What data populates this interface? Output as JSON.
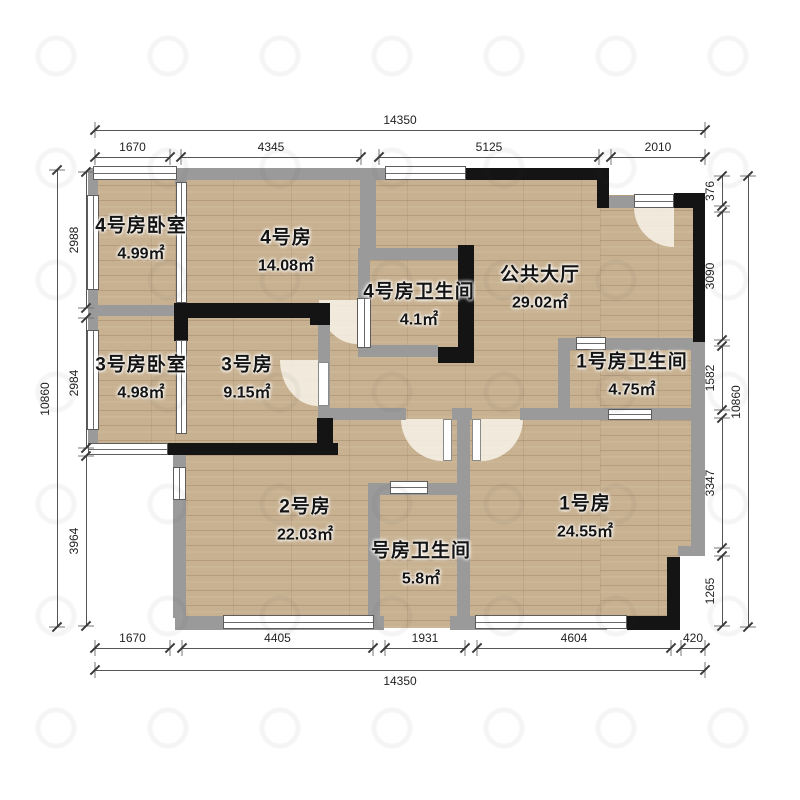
{
  "plan_title": "户型图",
  "colors": {
    "floor": "#c8b190",
    "wall_gray": "#9a9a9a",
    "wall_black": "#141414",
    "dim_text": "#222222",
    "door_arc": "#faf6ed",
    "background": "#ffffff"
  },
  "rooms": [
    {
      "id": "bedroom-4",
      "name": "4号房卧室",
      "area": "4.99㎡",
      "cx": 141,
      "cy": 237
    },
    {
      "id": "room-4",
      "name": "4号房",
      "area": "14.08㎡",
      "cx": 286,
      "cy": 249
    },
    {
      "id": "bath-4",
      "name": "4号房卫生间",
      "area": "4.1㎡",
      "cx": 419,
      "cy": 303
    },
    {
      "id": "public-hall",
      "name": "公共大厅",
      "area": "29.02㎡",
      "cx": 540,
      "cy": 286
    },
    {
      "id": "bedroom-3",
      "name": "3号房卧室",
      "area": "4.98㎡",
      "cx": 141,
      "cy": 376
    },
    {
      "id": "room-3",
      "name": "3号房",
      "area": "9.15㎡",
      "cx": 247,
      "cy": 376
    },
    {
      "id": "bath-1",
      "name": "1号房卫生间",
      "area": "4.75㎡",
      "cx": 632,
      "cy": 373
    },
    {
      "id": "room-2",
      "name": "2号房",
      "area": "22.03㎡",
      "cx": 305,
      "cy": 518
    },
    {
      "id": "bath-hall",
      "name": "号房卫生间",
      "area": "5.8㎡",
      "cx": 421,
      "cy": 562
    },
    {
      "id": "room-1",
      "name": "1号房",
      "area": "24.55㎡",
      "cx": 585,
      "cy": 515
    }
  ],
  "dimensions": {
    "top": {
      "total": {
        "label": "14350",
        "from": 95,
        "to": 705,
        "line": 130
      },
      "segments_line": 157,
      "segments": [
        {
          "label": "1670",
          "from": 95,
          "to": 170
        },
        {
          "label": "4345",
          "from": 181,
          "to": 361
        },
        {
          "label": "5125",
          "from": 379,
          "to": 599
        },
        {
          "label": "2010",
          "from": 611,
          "to": 705
        }
      ]
    },
    "bottom": {
      "total": {
        "label": "14350",
        "from": 95,
        "to": 705,
        "line": 670
      },
      "segments_line": 648,
      "segments": [
        {
          "label": "1670",
          "from": 95,
          "to": 170
        },
        {
          "label": "4405",
          "from": 182,
          "to": 373
        },
        {
          "label": "1931",
          "from": 385,
          "to": 465
        },
        {
          "label": "4604",
          "from": 477,
          "to": 671
        },
        {
          "label": "420",
          "from": 681,
          "to": 705
        }
      ]
    },
    "left": {
      "total": {
        "label": "10860",
        "from": 170,
        "to": 627,
        "line": 57
      },
      "segments_line": 86,
      "segments": [
        {
          "label": "2988",
          "from": 172,
          "to": 308
        },
        {
          "label": "2984",
          "from": 318,
          "to": 448
        },
        {
          "label": "3964",
          "from": 456,
          "to": 626
        }
      ]
    },
    "right": {
      "total": {
        "label": "10860",
        "from": 176,
        "to": 627,
        "line": 748
      },
      "segments_line": 722,
      "segments": [
        {
          "label": "376",
          "from": 176,
          "to": 206
        },
        {
          "label": "3090",
          "from": 212,
          "to": 340
        },
        {
          "label": "1582",
          "from": 346,
          "to": 410
        },
        {
          "label": "3347",
          "from": 418,
          "to": 548
        },
        {
          "label": "1265",
          "from": 556,
          "to": 626
        }
      ]
    }
  }
}
